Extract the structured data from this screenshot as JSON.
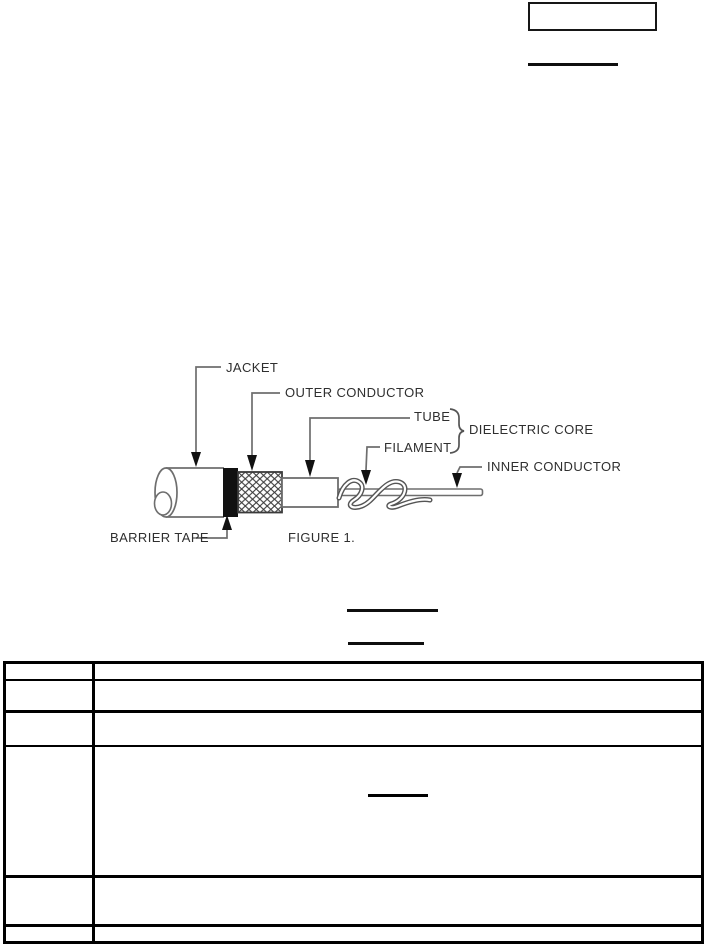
{
  "page": {
    "type": "scanned-technical-document",
    "background": "#ffffff"
  },
  "colors": {
    "line": "#6e6e6e",
    "text": "#2f2f2f",
    "ink": "#0f0f0f"
  },
  "figure": {
    "caption": "FIGURE 1.",
    "labels": {
      "jacket": "JACKET",
      "outer_conductor": "OUTER CONDUCTOR",
      "tube": "TUBE",
      "dielectric_core": "DIELECTRIC CORE",
      "filament": "FILAMENT",
      "inner_conductor": "INNER CONDUCTOR",
      "barrier_tape": "BARRIER TAPE"
    }
  },
  "table": {
    "rows": [
      {
        "left": "",
        "right": ""
      },
      {
        "left": "",
        "right": ""
      },
      {
        "left": "",
        "right": ""
      },
      {
        "left": "",
        "right": ""
      },
      {
        "left": "",
        "right": ""
      },
      {
        "left": "",
        "right": ""
      }
    ]
  }
}
